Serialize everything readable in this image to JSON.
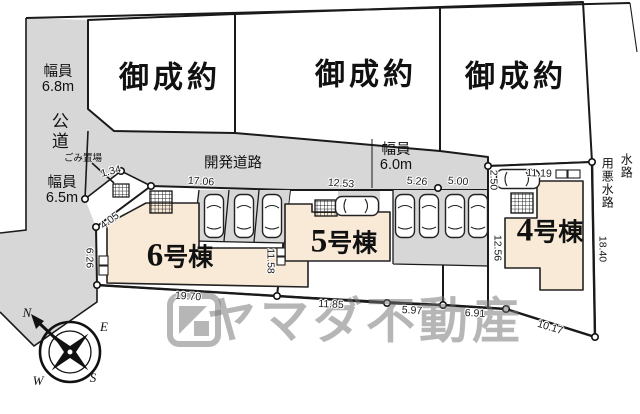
{
  "lots_sold": [
    "御成約",
    "御成約",
    "御成約"
  ],
  "roads": {
    "public_road": "公道",
    "dev_road": "開発道路",
    "width_top": {
      "l1": "幅員",
      "l2": "6.8m"
    },
    "width_bottom": {
      "l1": "幅員",
      "l2": "6.5m"
    },
    "width_dev": {
      "l1": "幅員",
      "l2": "6.0m"
    },
    "garbage": "ごみ置場",
    "waterway_long": "用悪水路",
    "waterway_short": "水路"
  },
  "buildings": [
    {
      "number": "6",
      "suffix": "号棟"
    },
    {
      "number": "5",
      "suffix": "号棟"
    },
    {
      "number": "4",
      "suffix": "号棟"
    }
  ],
  "dimensions": {
    "d134": "1.34",
    "d405": "4.05",
    "d626": "6.26",
    "d1706": "17.06",
    "d1253": "12.53",
    "d526": "5.26",
    "d500": "5.00",
    "d250": "2.50",
    "d1119": "11.19",
    "d1158": "11.58",
    "d1256": "12.56",
    "d1840": "18.40",
    "d1970": "19.70",
    "d1185": "11.85",
    "d597": "5.97",
    "d691": "6.91",
    "d1017": "10.17"
  },
  "compass": {
    "n": "N",
    "e": "E",
    "s": "S",
    "w": "W"
  },
  "watermark": {
    "company": "ヤマダ不動産"
  },
  "colors": {
    "road": "#d7d7d7",
    "building": "#f8ead7",
    "line": "#1a1a1a",
    "lot": "#ffffff"
  }
}
